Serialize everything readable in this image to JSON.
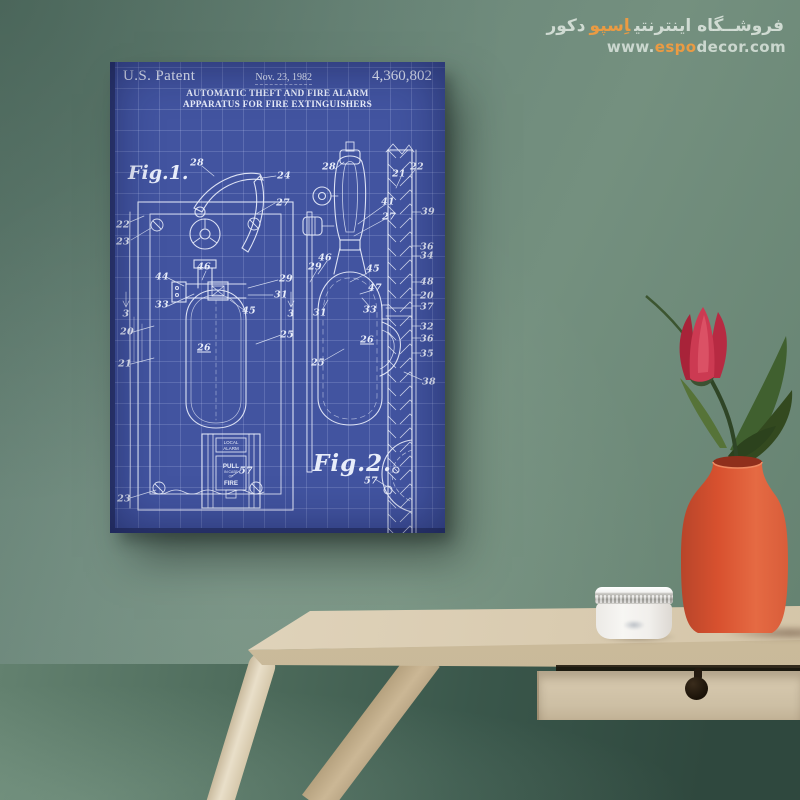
{
  "watermark": {
    "fa_prefix": "فروشــگاه اینترنتی",
    "fa_brand": "اِسپو",
    "fa_suffix": "دکور",
    "url_prefix": "www.",
    "url_brand": "espo",
    "url_suffix": "decor.com",
    "accent_color": "#eb9b43"
  },
  "poster": {
    "header": {
      "left": "U.S. Patent",
      "center": "Nov. 23, 1982",
      "right": "4,360,802"
    },
    "title_line1": "AUTOMATIC THEFT AND FIRE ALARM",
    "title_line2": "APPARATUS FOR FIRE EXTINGUISHERS",
    "fig1_caption": "Fig.1.",
    "fig2_caption": "Fig.2.",
    "alarm_box": {
      "line1": "LOCAL",
      "line2": "ALARM",
      "pull1": "PULL",
      "pull2": "IN CASE",
      "pull3": "OF",
      "pull4": "FIRE"
    },
    "colors": {
      "paper": "#4254a0",
      "ink": "#e8edfa",
      "grid": "#6d7fc0"
    },
    "labels": [
      {
        "text": "28",
        "x": 87,
        "y": 101
      },
      {
        "text": "24",
        "x": 174,
        "y": 114
      },
      {
        "text": "27",
        "x": 173,
        "y": 141
      },
      {
        "text": "22",
        "x": 13,
        "y": 163
      },
      {
        "text": "23",
        "x": 13,
        "y": 180
      },
      {
        "text": "46",
        "x": 94,
        "y": 205
      },
      {
        "text": "44",
        "x": 52,
        "y": 215
      },
      {
        "text": "29",
        "x": 176,
        "y": 217
      },
      {
        "text": "31",
        "x": 171,
        "y": 233
      },
      {
        "text": "33",
        "x": 52,
        "y": 243
      },
      {
        "text": "45",
        "x": 139,
        "y": 249
      },
      {
        "text": "3",
        "x": 16,
        "y": 252
      },
      {
        "text": "3",
        "x": 181,
        "y": 252
      },
      {
        "text": "20",
        "x": 17,
        "y": 270
      },
      {
        "text": "25",
        "x": 177,
        "y": 273
      },
      {
        "text": "26",
        "x": 94,
        "y": 286,
        "u": true
      },
      {
        "text": "21",
        "x": 15,
        "y": 302
      },
      {
        "text": "57",
        "x": 136,
        "y": 409
      },
      {
        "text": "23",
        "x": 14,
        "y": 437
      },
      {
        "text": "28",
        "x": 219,
        "y": 105
      },
      {
        "text": "21",
        "x": 289,
        "y": 112
      },
      {
        "text": "22",
        "x": 307,
        "y": 105
      },
      {
        "text": "41",
        "x": 278,
        "y": 140
      },
      {
        "text": "27",
        "x": 279,
        "y": 155
      },
      {
        "text": "39",
        "x": 318,
        "y": 150
      },
      {
        "text": "36",
        "x": 317,
        "y": 185
      },
      {
        "text": "34",
        "x": 317,
        "y": 194
      },
      {
        "text": "46",
        "x": 215,
        "y": 196
      },
      {
        "text": "29",
        "x": 205,
        "y": 205
      },
      {
        "text": "45",
        "x": 263,
        "y": 207
      },
      {
        "text": "48",
        "x": 317,
        "y": 220
      },
      {
        "text": "47",
        "x": 265,
        "y": 226
      },
      {
        "text": "20",
        "x": 317,
        "y": 234
      },
      {
        "text": "37",
        "x": 317,
        "y": 245
      },
      {
        "text": "31",
        "x": 210,
        "y": 251
      },
      {
        "text": "33",
        "x": 260,
        "y": 248
      },
      {
        "text": "32",
        "x": 317,
        "y": 265
      },
      {
        "text": "36",
        "x": 317,
        "y": 277
      },
      {
        "text": "35",
        "x": 317,
        "y": 292
      },
      {
        "text": "26",
        "x": 257,
        "y": 278,
        "u": true
      },
      {
        "text": "25",
        "x": 208,
        "y": 301
      },
      {
        "text": "38",
        "x": 319,
        "y": 320
      },
      {
        "text": "57",
        "x": 261,
        "y": 419
      }
    ]
  },
  "scene": {
    "wall_color": "#6b877a",
    "under_table_color": "#3a574b",
    "table_color": "#ddd1b8",
    "vase_color": "#dd5c38",
    "flower_color": "#c13048",
    "leaf_color": "#46602f",
    "jar_color": "#f2f1ee"
  }
}
